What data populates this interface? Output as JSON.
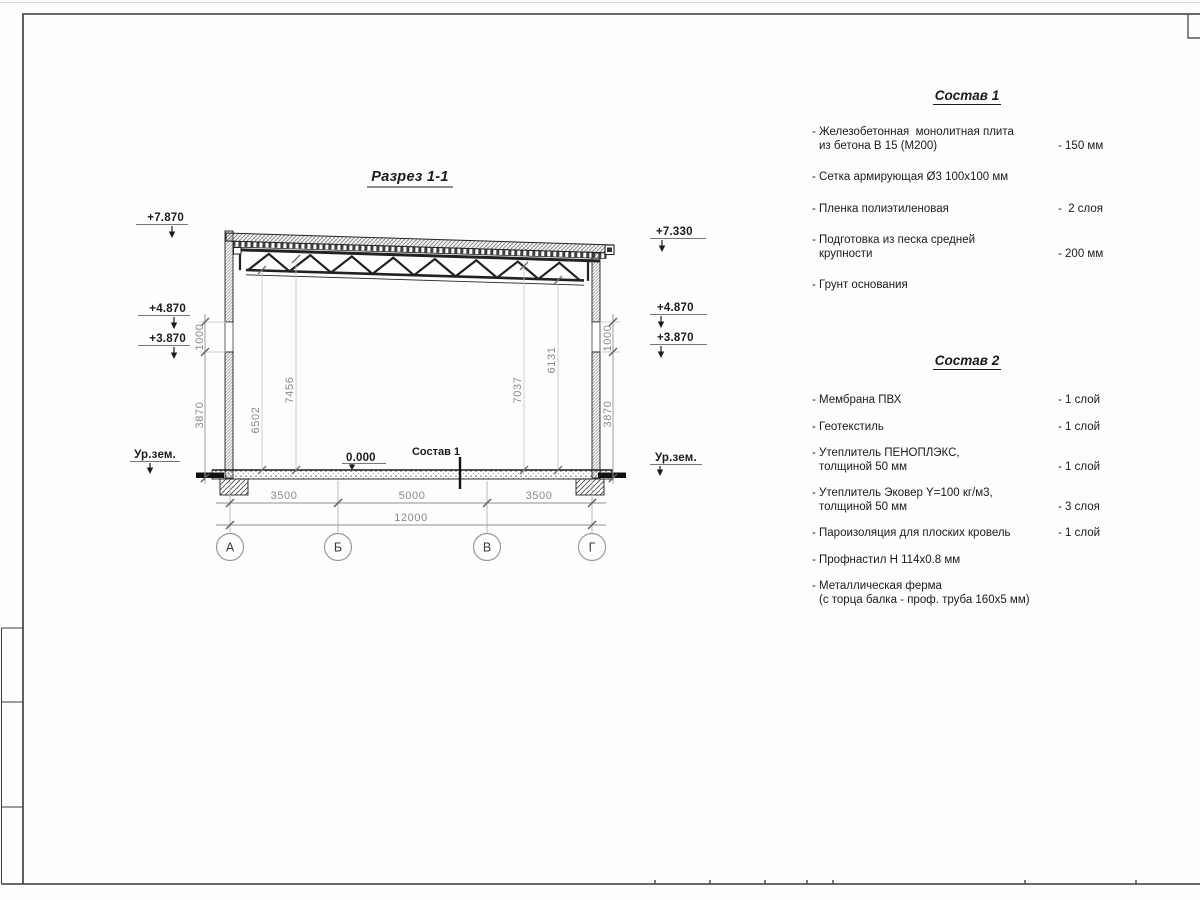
{
  "drawing": {
    "title": "Разрез 1-1",
    "zero_level": "0.000",
    "floor_leader_label": "Состав 1",
    "ground_left": "Ур.зем.",
    "ground_right": "Ур.зем.",
    "elev_left": [
      "+7.870",
      "+4.870",
      "+3.870"
    ],
    "elev_right": [
      "+7.330",
      "+4.870",
      "+3.870"
    ],
    "dim_left": [
      "1000",
      "3870"
    ],
    "dim_right": [
      "1000",
      "3870"
    ],
    "dim_interior": [
      "6502",
      "7456",
      "7037",
      "6131"
    ],
    "dim_spans": [
      "3500",
      "5000",
      "3500"
    ],
    "dim_total": "12000",
    "axes": [
      "А",
      "Б",
      "В",
      "Г"
    ]
  },
  "comp1": {
    "title": "Состав 1",
    "items": [
      {
        "l1": "- Железобетонная  монолитная плита",
        "l2": "из бетона В 15 (М200)",
        "value": "- 150 мм"
      },
      {
        "l1": "- Сетка армирующая Ø3 100х100 мм",
        "l2": "",
        "value": ""
      },
      {
        "l1": "- Пленка полиэтиленовая",
        "l2": "",
        "value": "-  2 слоя"
      },
      {
        "l1": "- Подготовка из песка средней",
        "l2": "крупности",
        "value": "- 200 мм"
      },
      {
        "l1": "- Грунт основания",
        "l2": "",
        "value": ""
      }
    ]
  },
  "comp2": {
    "title": "Состав 2",
    "items": [
      {
        "l1": "- Мембрана ПВХ",
        "l2": "",
        "value": "- 1 слой"
      },
      {
        "l1": "- Геотекстиль",
        "l2": "",
        "value": "- 1 слой"
      },
      {
        "l1": "- Утеплитель ПЕНОПЛЭКС,",
        "l2": "толщиной 50 мм",
        "value": "- 1 слой"
      },
      {
        "l1": "- Утеплитель Эковер Y=100 кг/м3,",
        "l2": "толщиной 50 мм",
        "value": "- 3 слоя"
      },
      {
        "l1": "- Пароизоляция для плоских кровель",
        "l2": "",
        "value": "- 1 слой"
      },
      {
        "l1": "- Профнастил Н 114х0.8 мм",
        "l2": "",
        "value": ""
      },
      {
        "l1": "- Металлическая ферма",
        "l2": "(с торца балка - проф. труба 160х5 мм)",
        "value": ""
      }
    ]
  }
}
